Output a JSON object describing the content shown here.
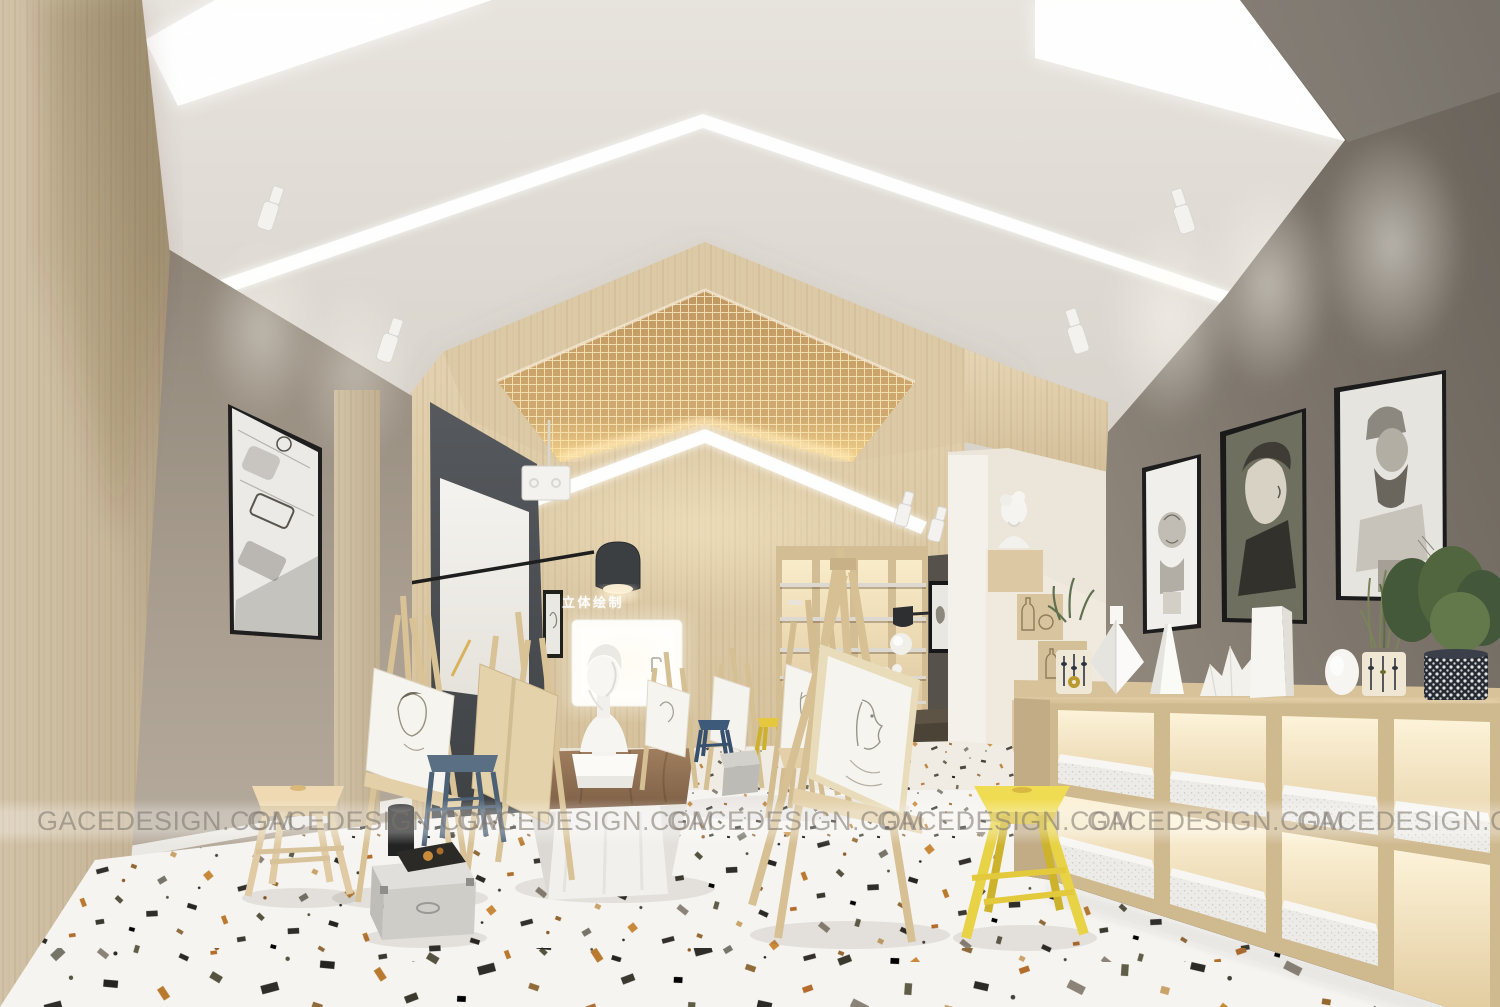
{
  "image": {
    "kind": "3D interior rendering",
    "subject": "art sketching studio / drawing classroom with easels, plaster busts and backlit shelving"
  },
  "wall_sign": {
    "text": "立体绘制"
  },
  "watermark": {
    "text": "GACEDESIGN.COM",
    "count": 7
  },
  "palette": {
    "ceiling": "#dcd7d0",
    "light_cove": "#fdfdfc",
    "wood_light": "#ddcaa6",
    "mesh_panel": "#c59c63",
    "wall_left_taupe": "#a79c8e",
    "wall_right_gray": "#7a7369",
    "blackboard": "#4b4e52",
    "floor_terrazzo_base": "#f6f4f0",
    "stool_yellow": "#edd94e",
    "stool_blue": "#3e5a7a",
    "stool_slate": "#5a6f83",
    "drape_brown": "#8d6f54",
    "shelf_glow": "#f7e8c8"
  },
  "inventory": [
    "gabled ceiling with chevron LED light coves",
    "wood lattice mesh gable panel",
    "framed geometric pencil sketch on left wall",
    "blackboard with projection screen and arc lamp",
    "backlit wall niche with plaster bust on draped table",
    "backlit bookshelf wall unit",
    "stair-step display with plaster bust and bottle line-art",
    "three framed charcoal bust portraits on right wall",
    "low backlit cubby shelving with speckled slabs",
    "six wooden sketch easels",
    "stools: yellow, navy, slate-blue, natural wood",
    "storage box, sketchbook, black bin",
    "patterned plant pots and white plaster vases",
    "white terrazzo floor with multicolor chips"
  ]
}
